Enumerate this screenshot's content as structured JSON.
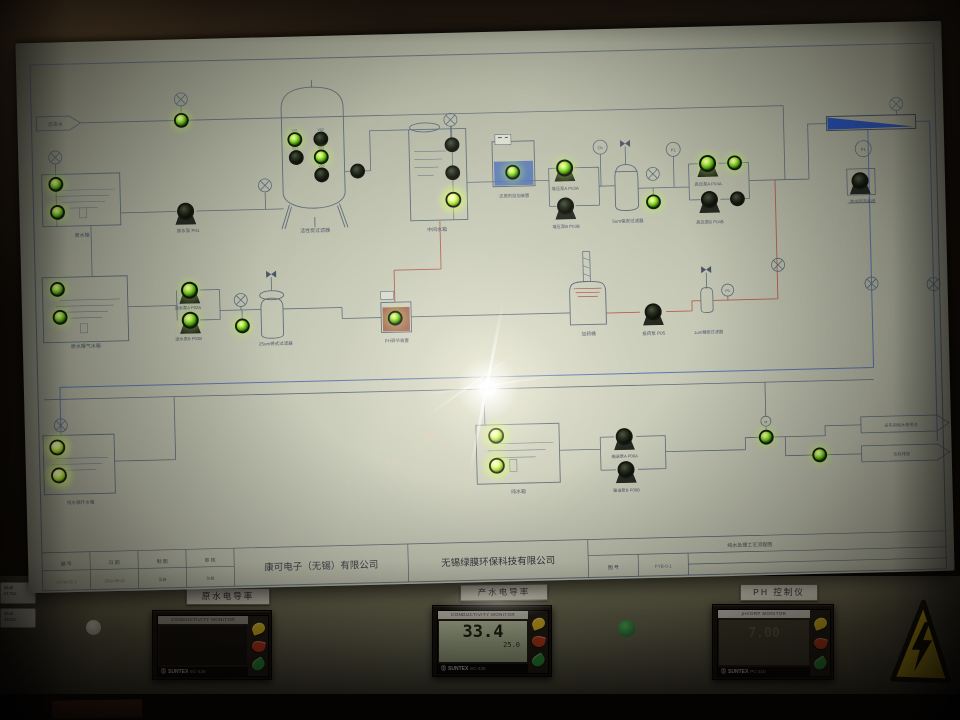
{
  "board": {
    "inlet_label": "自来水",
    "labels": {
      "raw_tank": "原水箱",
      "raw_pump": "原水泵 P01",
      "carbon_filter": "活性炭过滤器",
      "mid_tank": "中间水箱",
      "reducer_dosing": "还原剂投加装置",
      "boost_pump_a": "增压泵A P03A",
      "boost_pump_b": "增压泵B P03B",
      "security_filter": "5um保安过滤器",
      "hp_pump_a": "高压泵A P04A",
      "hp_pump_b": "高压泵B P04B",
      "conc_return": "浓水回流系统",
      "aeration_tank": "原水曝气水箱",
      "feed_pump_a": "送水泵A P02A",
      "feed_pump_b": "送水泵B P02B",
      "bag_filter": "25um袋式过滤器",
      "ph_device": "PH调节装置",
      "dosing_tank": "加药桶",
      "dosing_pump": "投药泵 P05",
      "fine_filter": "1um精密过滤器",
      "recycle_tank": "纯水循环水箱",
      "pure_tank": "纯水箱",
      "transfer_pump_a": "输送泵A P06A",
      "transfer_pump_b": "输送泵B P06B",
      "outlet_use": "去车间纯水使用点",
      "outlet_drain": "达标排放"
    },
    "valves": {
      "v1": "V01",
      "v2": "V02",
      "v3": "V03",
      "v4": "V04",
      "v5": "V05"
    },
    "gauges": {
      "p1": "P1",
      "cb": "Cb",
      "m": "M"
    },
    "title_block": {
      "c1_label": "编 号",
      "c1_value": "GT-W-01-1",
      "c2_label": "日 期",
      "c2_value": "2011-06-12",
      "c3_label": "制 图",
      "c3_value": "吴春",
      "c4_label": "审 核",
      "c4_value": "陈敏",
      "company_left": "康可电子（无锡）有限公司",
      "company_right": "无锡绿膜环保科技有限公司",
      "drawing_title": "纯水处理工艺流程图",
      "drawing_no_label": "图 号",
      "drawing_no_value": "FYB-0-1"
    }
  },
  "panel": {
    "meters": [
      {
        "plate": "原水电导率",
        "header": "CONDUCTIVITY MONITOR",
        "main": "",
        "sub": "",
        "brand": "SUNTEX",
        "model": "EC-430"
      },
      {
        "plate": "产水电导率",
        "header": "CONDUCTIVITY MONITOR",
        "main": "33.4",
        "sub": "25.0",
        "brand": "SUNTEX",
        "model": "EC-430"
      },
      {
        "plate": "PH 控制仪",
        "header": "pH/ORP MONITOR",
        "main": "7.00",
        "sub": "",
        "brand": "SUNTEX",
        "model": "PC-310"
      }
    ],
    "tags": {
      "t1a": "itibal",
      "t1b": "01781",
      "t2a": "itibal",
      "t2b": "41181"
    }
  }
}
